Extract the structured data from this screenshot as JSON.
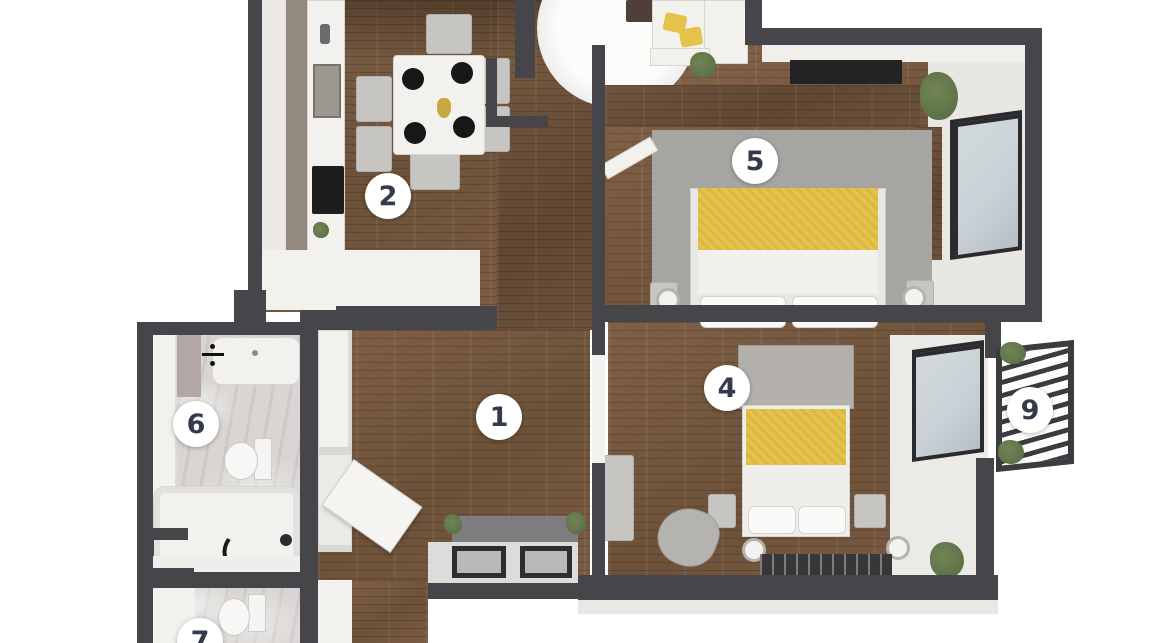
{
  "badges": [
    {
      "label": "1"
    },
    {
      "label": "2"
    },
    {
      "label": "4"
    },
    {
      "label": "5"
    },
    {
      "label": "6"
    },
    {
      "label": "7"
    },
    {
      "label": "9"
    }
  ],
  "colors": {
    "wall": "#46464a",
    "wood": "#7b5e45",
    "wood_dark": "#664c37",
    "tile": "#d8d5d2",
    "yellow": "#e5c24a",
    "glass": "#c9d1d6",
    "white_furniture": "#f2f1ee",
    "gray_furniture": "#c7c5c2",
    "rug_gray": "#a7a5a2",
    "dark_rug": "#37373a",
    "plant": "#5d7247",
    "badge_bg": "#ffffff",
    "badge_text": "#333a4a"
  }
}
